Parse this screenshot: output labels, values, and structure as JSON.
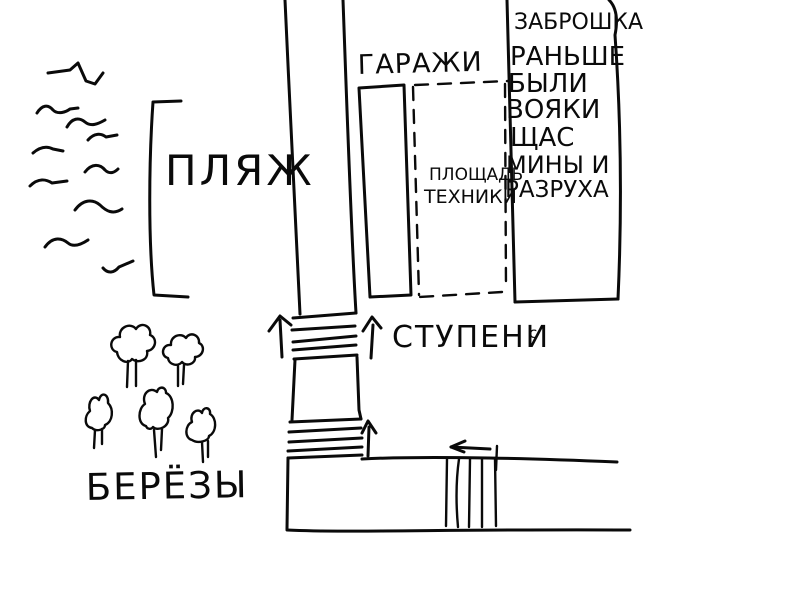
{
  "canvas": {
    "background": "#ffffff",
    "ink": "#0a0a0a"
  },
  "map": {
    "beach": {
      "label": "ПЛЯЖ"
    },
    "garages": {
      "label": "ГАРАЖИ"
    },
    "equipment_area": {
      "line1": "ПЛОЩАДЬ",
      "line2": "ТЕХНИКИ"
    },
    "abandoned": {
      "lines": [
        "ЗАБРОШКА",
        "РАНЬШЕ",
        "БЫЛИ",
        "ВОЯКИ",
        "ЩАС",
        "МИНЫ И",
        "РАЗРУХА"
      ]
    },
    "stairs": {
      "label": "СТУПЕНИ",
      "suffix": "с"
    },
    "birches": {
      "label": "БЕРЁЗЫ"
    },
    "counts": {
      "waves": 10,
      "trees": 5,
      "upper_steps": 5,
      "lower_steps": 5,
      "crosswalk_stripes": 5,
      "arrows": 4
    }
  }
}
